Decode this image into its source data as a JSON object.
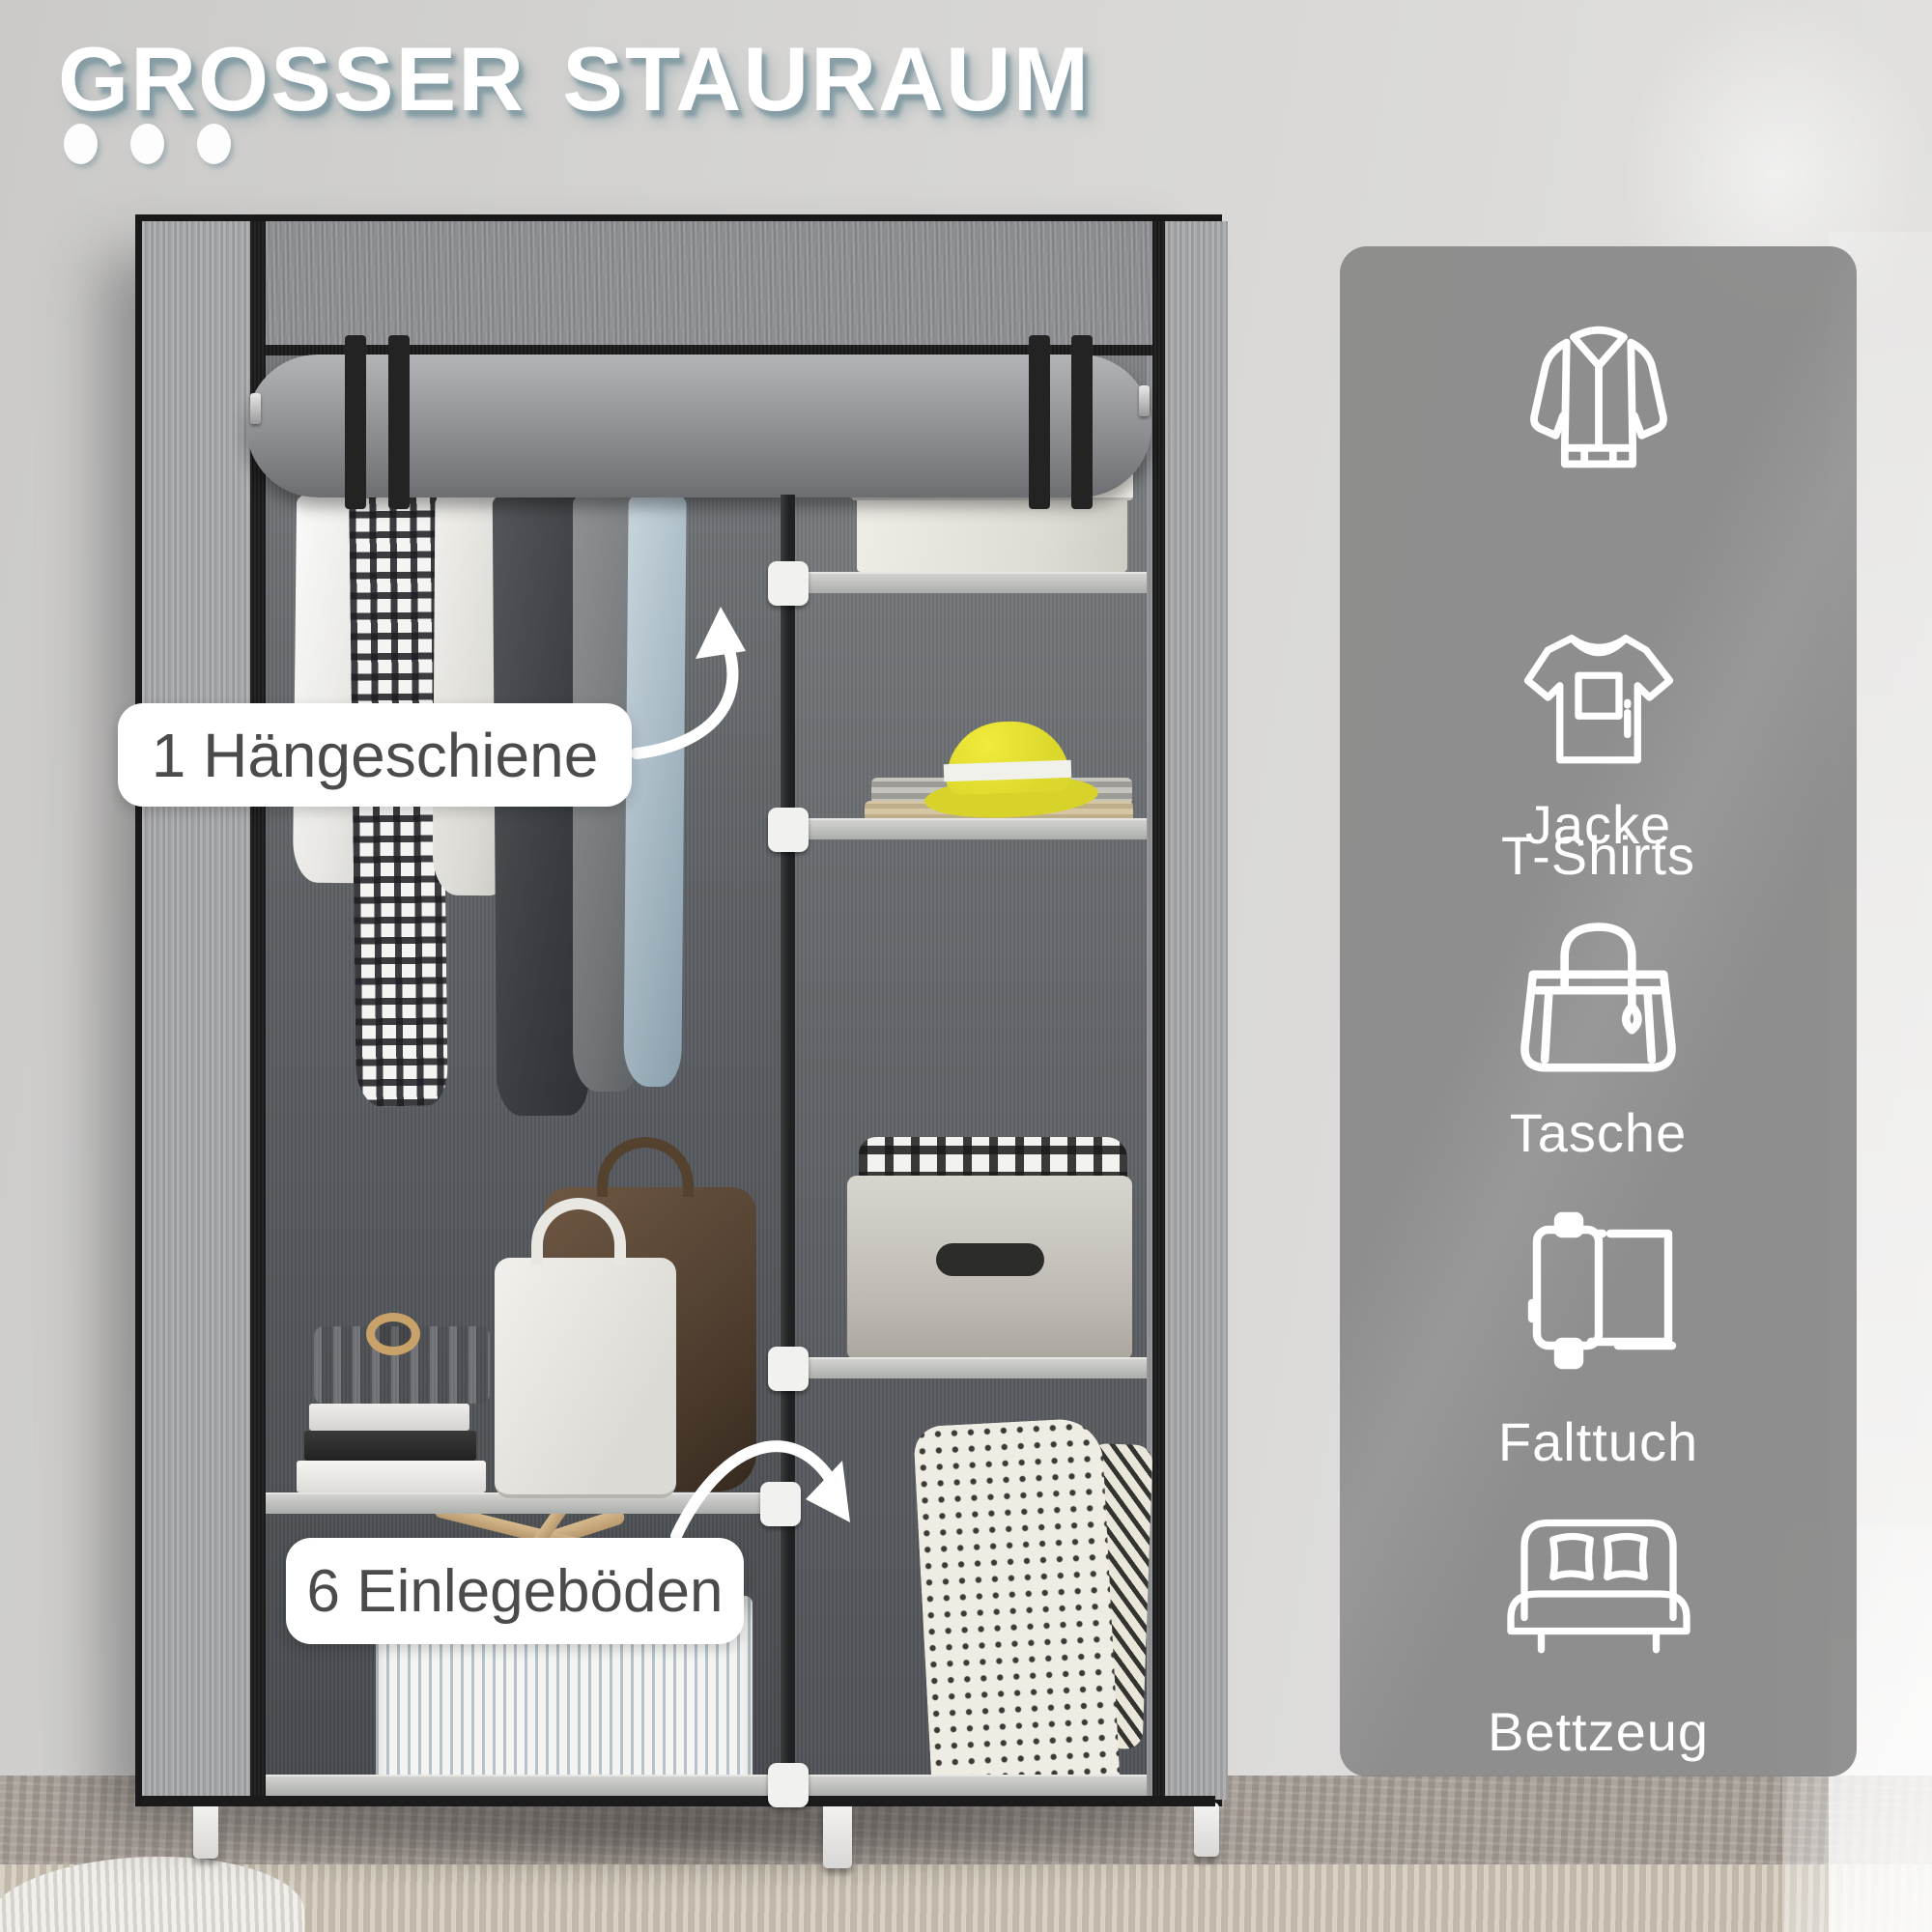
{
  "title": {
    "text": "GROSSER STAURAUM"
  },
  "title_dots": 3,
  "callouts": {
    "hanging_rail": {
      "text": "1 Hängeschiene"
    },
    "shelves": {
      "text": "6 Einlegeböden"
    }
  },
  "sidebar": {
    "items": [
      {
        "icon": "jacket-icon",
        "label": "Jacke"
      },
      {
        "icon": "tshirt-icon",
        "label": "T-Shirts"
      },
      {
        "icon": "tote-bag-icon",
        "label": "Tasche"
      },
      {
        "icon": "folded-cloth-icon",
        "label": "Falttuch"
      },
      {
        "icon": "bed-icon",
        "label": "Bettzeug"
      }
    ]
  },
  "colors": {
    "title_text": "#ffffff",
    "title_shadow": "#8ba1ab",
    "callout_bg": "#ffffff",
    "callout_text": "#4b4b4b",
    "sidebar_panel": "#878787",
    "sidebar_text": "#ffffff",
    "hat_accent": "#e0db2d",
    "wardrobe_fabric": "#9a9b9e",
    "frame_trim": "#1b1b1b"
  }
}
